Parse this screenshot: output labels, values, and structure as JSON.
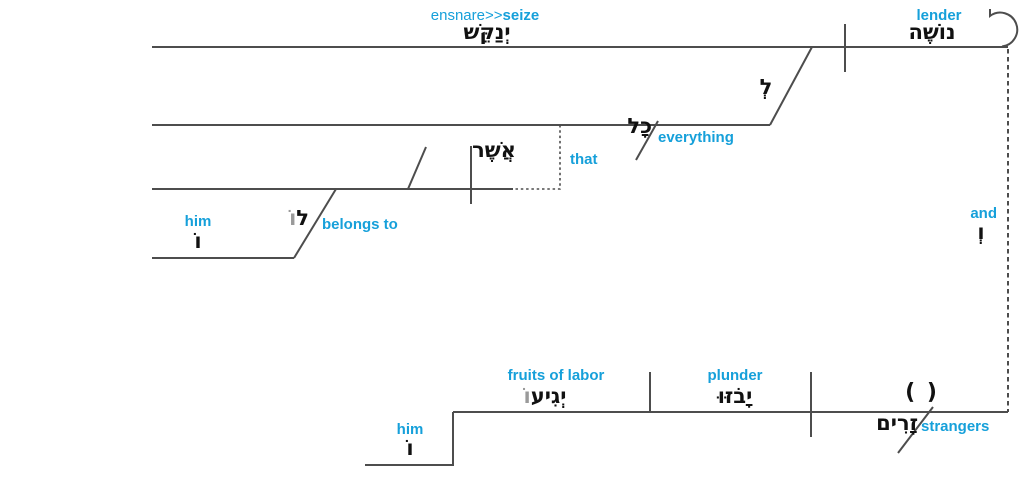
{
  "colors": {
    "accent_blue": "#16a0da",
    "ink_black": "#111111",
    "suffix_gray": "#9a9a9a",
    "line_gray": "#4d4d4d"
  },
  "clause1": {
    "verb": {
      "gloss_plain": "ensnare>>",
      "gloss_bold": "seize",
      "hebrew": "יְנַקֵּשׁ"
    },
    "subject": {
      "gloss": "lender",
      "hebrew": "נוֹשֶׁה"
    },
    "preposition": {
      "hebrew": "לְ"
    },
    "object": {
      "gloss": "everything",
      "hebrew": "כָל"
    },
    "relative": {
      "gloss": "that",
      "hebrew": "אֲשֶׁר"
    },
    "predicate": {
      "gloss": "belongs to",
      "hebrew_base": "ל",
      "hebrew_suffix": "וֹ"
    },
    "suffix_him": {
      "gloss": "him",
      "hebrew": "וֹ"
    }
  },
  "conjunction": {
    "gloss": "and",
    "hebrew": "וְ"
  },
  "clause2": {
    "object": {
      "gloss": "fruits of labor",
      "hebrew_base": "יְגִיע",
      "hebrew_suffix": "וֹ"
    },
    "verb": {
      "gloss": "plunder",
      "hebrew": "יָבֹזּוּ"
    },
    "subject": {
      "gloss": "strangers",
      "hebrew": "זָרִים",
      "placeholder": "( )"
    },
    "suffix_him": {
      "gloss": "him",
      "hebrew": "וֹ"
    }
  }
}
